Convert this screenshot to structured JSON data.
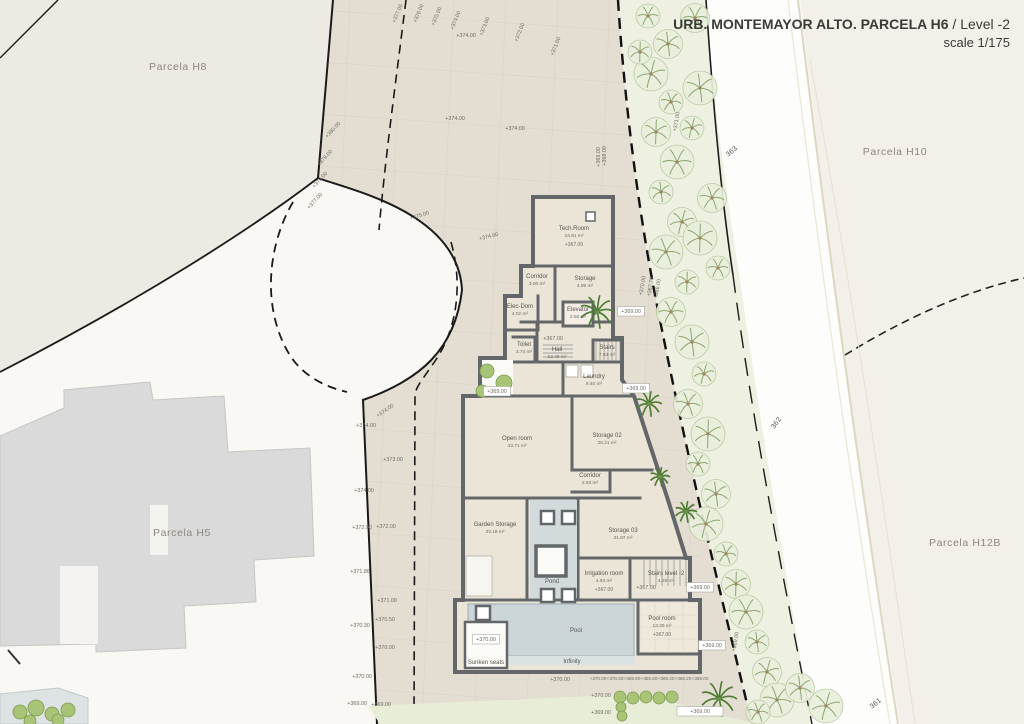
{
  "title": {
    "main": "URB. MONTEMAYOR ALTO. PARCELA H6",
    "separator": "/",
    "level": "Level -2",
    "scale": "scale 1/175"
  },
  "colors": {
    "site_fill": "#e4ded2",
    "wall_gray": "#63676a",
    "pool_blue": "#ccd6d8",
    "tree_green": "#8ba671",
    "palm_green": "#4e7c33",
    "parcel_bg_left": "#edeae3",
    "parcel_bg_right": "#f3f0ea",
    "grey_building": "#dadada"
  },
  "parcels": [
    {
      "label": "Parcela H8",
      "x": 178,
      "y": 70
    },
    {
      "label": "Parcela H10",
      "x": 895,
      "y": 155
    },
    {
      "label": "Parcela H5",
      "x": 182,
      "y": 536
    },
    {
      "label": "Parcela H12B",
      "x": 965,
      "y": 546
    }
  ],
  "road_labels": [
    {
      "text": "363",
      "x": 733,
      "y": 153,
      "r": -40
    },
    {
      "text": "362",
      "x": 778,
      "y": 424,
      "r": -55
    },
    {
      "text": "361",
      "x": 877,
      "y": 705,
      "r": -40
    }
  ],
  "rooms": [
    {
      "name": "Tech.Room",
      "area": "24.81 m²",
      "elev": "+367.00",
      "x": 574,
      "y": 230
    },
    {
      "name": "Corridor",
      "area": "3.00 m²",
      "x": 537,
      "y": 278
    },
    {
      "name": "Storage",
      "area": "4.99 m²",
      "x": 585,
      "y": 280
    },
    {
      "name": "Elec-Dom",
      "area": "4.02 m²",
      "x": 520,
      "y": 308
    },
    {
      "name": "Elevator",
      "area": "2.56 m²",
      "x": 578,
      "y": 311
    },
    {
      "name": "Toilet",
      "area": "3.74 m²",
      "x": 524,
      "y": 346
    },
    {
      "name": "Hall",
      "area": "13.48 m²",
      "x": 557,
      "y": 351
    },
    {
      "name": "Stairs",
      "area": "7.93 m²",
      "x": 607,
      "y": 349
    },
    {
      "name": "Laundry",
      "area": "9.40 m²",
      "x": 594,
      "y": 378
    },
    {
      "name": "Open room",
      "area": "43.71 m²",
      "x": 517,
      "y": 440
    },
    {
      "name": "Storage 02",
      "area": "28.21 m²",
      "x": 607,
      "y": 437
    },
    {
      "name": "Corridor",
      "area": "2.93 m²",
      "x": 590,
      "y": 477
    },
    {
      "name": "Garden Storage",
      "area": "33.18 m²",
      "x": 495,
      "y": 526
    },
    {
      "name": "Storage 03",
      "area": "31.87 m²",
      "x": 623,
      "y": 532
    },
    {
      "name": "Pond",
      "x": 552,
      "y": 583
    },
    {
      "name": "Irrigation room",
      "area": "4.83 m²",
      "elev": "+367.00",
      "x": 604,
      "y": 575
    },
    {
      "name": "Stairs level -2",
      "area": "4.29 m²",
      "x": 666,
      "y": 575
    },
    {
      "name": "Pool room",
      "area": "13.39 m²",
      "elev": "+367.00",
      "x": 662,
      "y": 620
    },
    {
      "name": "Pool",
      "x": 576,
      "y": 632
    },
    {
      "name": "Sunken seats",
      "x": 486,
      "y": 664
    },
    {
      "name": "Infinity",
      "x": 572,
      "y": 663
    }
  ],
  "elevation_markers": [
    {
      "t": "+377.00",
      "x": 399,
      "y": 14,
      "r": -68
    },
    {
      "t": "+376.00",
      "x": 420,
      "y": 14,
      "r": -68
    },
    {
      "t": "+375.00",
      "x": 438,
      "y": 17,
      "r": -68
    },
    {
      "t": "+374.00",
      "x": 457,
      "y": 21,
      "r": -68
    },
    {
      "t": "+373.00",
      "x": 486,
      "y": 27,
      "r": -68
    },
    {
      "t": "+372.00",
      "x": 521,
      "y": 33,
      "r": -68
    },
    {
      "t": "+371.00",
      "x": 557,
      "y": 47,
      "r": -68
    },
    {
      "t": "+371.00",
      "x": 678,
      "y": 122,
      "r": -80
    },
    {
      "t": "+374.00",
      "x": 466,
      "y": 37
    },
    {
      "t": "+374.00",
      "x": 455,
      "y": 120
    },
    {
      "t": "+374.00",
      "x": 515,
      "y": 130
    },
    {
      "t": "+380.00",
      "x": 334,
      "y": 131,
      "r": -48
    },
    {
      "t": "+379.00",
      "x": 326,
      "y": 159,
      "r": -48
    },
    {
      "t": "+378.00",
      "x": 321,
      "y": 181,
      "r": -48
    },
    {
      "t": "+377.00",
      "x": 316,
      "y": 202,
      "r": -48
    },
    {
      "t": "+375.00",
      "x": 420,
      "y": 217,
      "r": -18
    },
    {
      "t": "+374.00",
      "x": 489,
      "y": 238,
      "r": -14
    },
    {
      "t": "+374.00",
      "x": 386,
      "y": 412,
      "r": -35
    },
    {
      "t": "+374.00",
      "x": 366,
      "y": 427
    },
    {
      "t": "+373.00",
      "x": 393,
      "y": 461
    },
    {
      "t": "+374.00",
      "x": 364,
      "y": 492
    },
    {
      "t": "+372.00",
      "x": 386,
      "y": 528
    },
    {
      "t": "+372.90",
      "x": 362,
      "y": 529
    },
    {
      "t": "+371.86",
      "x": 360,
      "y": 573
    },
    {
      "t": "+371.00",
      "x": 387,
      "y": 602
    },
    {
      "t": "+370.50",
      "x": 385,
      "y": 621
    },
    {
      "t": "+370.30",
      "x": 360,
      "y": 627
    },
    {
      "t": "+370.00",
      "x": 385,
      "y": 649
    },
    {
      "t": "+370.00",
      "x": 362,
      "y": 678
    },
    {
      "t": "+369.00",
      "x": 357,
      "y": 705
    },
    {
      "t": "+369.00",
      "x": 381,
      "y": 706
    },
    {
      "t": "+369.00",
      "x": 600,
      "y": 157,
      "r": -90
    },
    {
      "t": "+368.00",
      "x": 606,
      "y": 156,
      "r": -90
    },
    {
      "t": "+370.00",
      "x": 644,
      "y": 286,
      "r": -80
    },
    {
      "t": "+367.70",
      "x": 652,
      "y": 287,
      "r": -80
    },
    {
      "t": "+366.00",
      "x": 659,
      "y": 289,
      "r": -80
    },
    {
      "t": "+369.00",
      "x": 631,
      "y": 313,
      "box": true
    },
    {
      "t": "+369.00",
      "x": 636,
      "y": 390,
      "box": true
    },
    {
      "t": "+367.00",
      "x": 553,
      "y": 340
    },
    {
      "t": "+367.00",
      "x": 646,
      "y": 589
    },
    {
      "t": "+369.00",
      "x": 700,
      "y": 589,
      "box": true
    },
    {
      "t": "+369.00",
      "x": 712,
      "y": 647,
      "box": true
    },
    {
      "t": "+369.00",
      "x": 737,
      "y": 642,
      "r": -80
    },
    {
      "t": "+370.00",
      "x": 560,
      "y": 681
    },
    {
      "t": "+370.00",
      "x": 598,
      "y": 680,
      "s": 1
    },
    {
      "t": "+370.00",
      "x": 615,
      "y": 680,
      "s": 1
    },
    {
      "t": "+369.90",
      "x": 632,
      "y": 680,
      "s": 1
    },
    {
      "t": "+369.60",
      "x": 649,
      "y": 680,
      "s": 1
    },
    {
      "t": "+369.40",
      "x": 666,
      "y": 680,
      "s": 1
    },
    {
      "t": "+369.20",
      "x": 683,
      "y": 680,
      "s": 1
    },
    {
      "t": "+369.00",
      "x": 700,
      "y": 680,
      "s": 1
    },
    {
      "t": "+370.00",
      "x": 601,
      "y": 697
    },
    {
      "t": "+369.00",
      "x": 601,
      "y": 714
    },
    {
      "t": "+369.00",
      "x": 700,
      "y": 713,
      "box": true,
      "bw": 46
    },
    {
      "t": "+369.00",
      "x": 497,
      "y": 393,
      "box": true
    },
    {
      "t": "+370.00",
      "x": 486,
      "y": 641,
      "box": true
    }
  ],
  "vegetation": {
    "trees": [
      [
        648,
        16
      ],
      [
        668,
        44
      ],
      [
        651,
        74
      ],
      [
        671,
        102
      ],
      [
        656,
        132
      ],
      [
        677,
        162
      ],
      [
        661,
        192
      ],
      [
        682,
        222
      ],
      [
        666,
        252
      ],
      [
        687,
        282
      ],
      [
        671,
        312
      ],
      [
        692,
        342
      ],
      [
        704,
        374
      ],
      [
        688,
        404
      ],
      [
        708,
        434
      ],
      [
        698,
        464
      ],
      [
        716,
        494
      ],
      [
        706,
        524
      ],
      [
        726,
        554
      ],
      [
        736,
        584
      ],
      [
        746,
        612
      ],
      [
        757,
        642
      ],
      [
        767,
        672
      ],
      [
        777,
        700
      ],
      [
        640,
        52
      ],
      [
        695,
        18
      ],
      [
        700,
        88
      ],
      [
        692,
        128
      ],
      [
        712,
        198
      ],
      [
        700,
        238
      ],
      [
        718,
        268
      ],
      [
        800,
        688
      ],
      [
        826,
        706
      ],
      [
        758,
        712
      ]
    ],
    "palms": [
      [
        597,
        312,
        17
      ],
      [
        649,
        404,
        13
      ],
      [
        660,
        477,
        10
      ],
      [
        686,
        512,
        11
      ],
      [
        719,
        699,
        18
      ]
    ],
    "bushes": [
      [
        487,
        371,
        7
      ],
      [
        504,
        383,
        8
      ],
      [
        482,
        391,
        6
      ],
      [
        620,
        697,
        6
      ],
      [
        633,
        698,
        6
      ],
      [
        646,
        697,
        6
      ],
      [
        659,
        698,
        6
      ],
      [
        672,
        697,
        6
      ],
      [
        621,
        707,
        5
      ],
      [
        622,
        716,
        5
      ],
      [
        20,
        712,
        7
      ],
      [
        36,
        708,
        8
      ],
      [
        52,
        714,
        7
      ],
      [
        68,
        710,
        7
      ],
      [
        30,
        721,
        6
      ],
      [
        58,
        720,
        6
      ]
    ]
  }
}
